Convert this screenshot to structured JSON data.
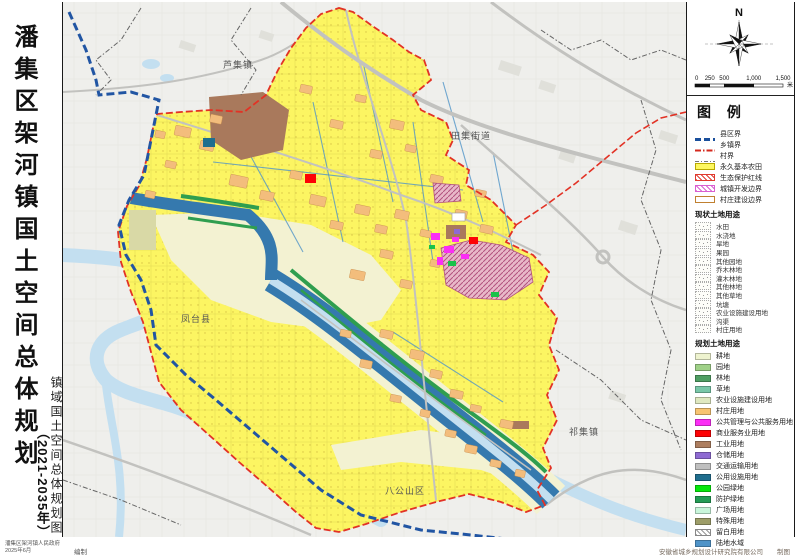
{
  "sheet": {
    "title_main": "潘集区架河镇国土空间总体规划",
    "title_sub": "（2021-2035年）",
    "map_title_vertical": "镇域国土空间总体规划图",
    "footer_left_line1": "潘集区架河镇人民政府",
    "footer_left_line2": "2025年6月",
    "footer_left_suffix": "编制",
    "footer_right": "安徽省城乡规划设计研究院有限公司",
    "footer_right_suffix": "制图"
  },
  "compass": {
    "north_label": "N"
  },
  "scalebar": {
    "tick_labels": [
      "0",
      "250",
      "500",
      "1,000",
      "1,500"
    ],
    "unit": "米"
  },
  "legend": {
    "title": "图 例",
    "boundary_items": [
      {
        "label": "县区界",
        "kind": "line",
        "color": "#1a4f9c",
        "dash": "6,3",
        "width": 3
      },
      {
        "label": "乡镇界",
        "kind": "line",
        "color": "#d4291e",
        "dash": "6,2,1.5,2",
        "width": 2
      },
      {
        "label": "村界",
        "kind": "line",
        "color": "#777777",
        "dash": "4,2,1,2",
        "width": 1
      },
      {
        "label": "永久基本农田",
        "kind": "fill",
        "color": "#fdf75f"
      },
      {
        "label": "生态保护红线",
        "kind": "hatch",
        "color": "#e03a2f"
      },
      {
        "label": "城镇开发边界",
        "kind": "hatch",
        "color": "#d95fd0"
      },
      {
        "label": "村庄建设边界",
        "kind": "outline",
        "color": "#c08030"
      }
    ],
    "current_header": "现状土地用途",
    "current_items": [
      "水田",
      "水浇地",
      "旱地",
      "果园",
      "其他园地",
      "乔木林地",
      "灌木林地",
      "其他林地",
      "其他草地",
      "坑塘",
      "农业设施建设用地",
      "沟渠",
      "村庄用地"
    ],
    "planned_header": "规划土地用途",
    "planned_items": [
      {
        "label": "耕地",
        "color": "#eef3cf"
      },
      {
        "label": "园地",
        "color": "#9fd188"
      },
      {
        "label": "林地",
        "color": "#4f9e63"
      },
      {
        "label": "草地",
        "color": "#79c7a8"
      },
      {
        "label": "农业设施建设用地",
        "color": "#dfe8c0"
      },
      {
        "label": "村庄用地",
        "color": "#f8c471"
      },
      {
        "label": "公共管理与公共服务用地",
        "color": "#fb2ef5"
      },
      {
        "label": "商业服务业用地",
        "color": "#fd0205"
      },
      {
        "label": "工业用地",
        "color": "#ad7e5f"
      },
      {
        "label": "仓储用地",
        "color": "#8e6ad2"
      },
      {
        "label": "交通运输用地",
        "color": "#bfbfbf"
      },
      {
        "label": "公用设施用地",
        "color": "#206e8e"
      },
      {
        "label": "公园绿地",
        "color": "#06e70c"
      },
      {
        "label": "防护绿地",
        "color": "#239b55"
      },
      {
        "label": "广场用地",
        "color": "#c9f6db"
      },
      {
        "label": "特殊用地",
        "color": "#9d9d68"
      },
      {
        "label": "留白用地",
        "color": "#ffffff",
        "hatch": true
      },
      {
        "label": "陆地水域",
        "color": "#4f93c8"
      }
    ]
  },
  "map_labels": [
    {
      "text": "芦集镇",
      "x": 175,
      "y": 66
    },
    {
      "text": "田集街道",
      "x": 408,
      "y": 137
    },
    {
      "text": "凤台县",
      "x": 133,
      "y": 320
    },
    {
      "text": "八公山区",
      "x": 342,
      "y": 492
    },
    {
      "text": "祁集镇",
      "x": 521,
      "y": 433
    }
  ],
  "colors": {
    "outside_bg": "#efefec",
    "farmland_yellow": "#fcf562",
    "floodplain_cream": "#f3f2d2",
    "village_orange": "#f3bd7c",
    "industry_brown": "#a9795c",
    "water_dark": "#3579ae",
    "water_light": "#c3dff0",
    "green_strip": "#2f9e4f",
    "road_gray": "#c2c2bf",
    "boundary_red": "#e23225",
    "boundary_blue": "#2155a3",
    "dev_hatch_fill": "#e8b8c8",
    "dev_hatch_line": "#b2527e"
  }
}
